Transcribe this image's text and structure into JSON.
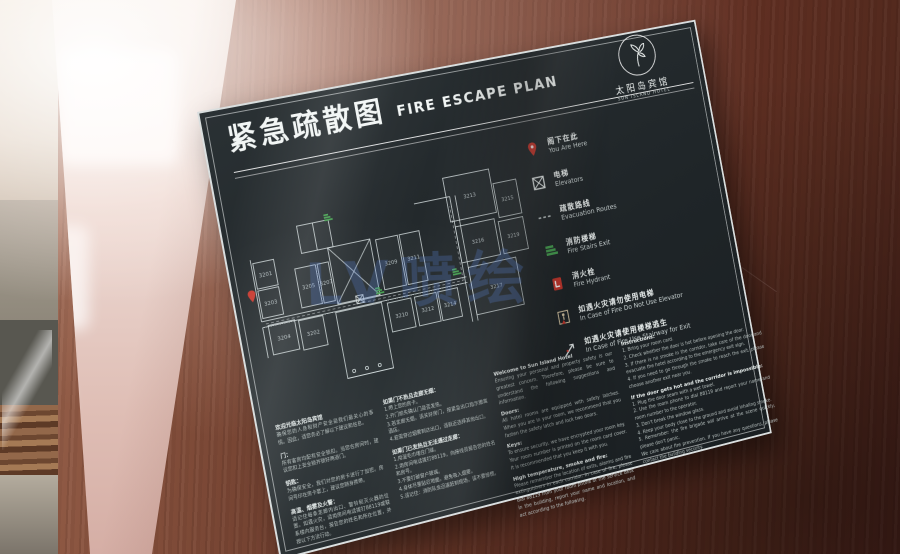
{
  "photo": {
    "watermark": "LV喷绘"
  },
  "sign": {
    "title_cn": "紧急疏散图",
    "title_en": "FIRE ESCAPE PLAN",
    "logo": {
      "name_cn": "太阳岛宾馆",
      "name_en": "SUN ISLAND HOTEL"
    },
    "colors": {
      "accent_red": "#c8372d",
      "stair_green": "#46a351",
      "wall_line": "#d8e1e2",
      "label": "#c6d0d2"
    },
    "legend": {
      "items": [
        {
          "icon": "you-are-here-pin",
          "cn": "阁下在此",
          "en": "You Are Here"
        },
        {
          "icon": "elevator",
          "cn": "电梯",
          "en": "Elevators"
        },
        {
          "icon": "evacuation-route",
          "cn": "疏散路线",
          "en": "Evacuation Routes"
        },
        {
          "icon": "fire-stairs",
          "cn": "消防楼梯",
          "en": "Fire Stairs Exit"
        },
        {
          "icon": "fire-hydrant",
          "cn": "消火栓",
          "en": "Fire Hydrant"
        },
        {
          "icon": "no-elevator",
          "cn": "如遇火灾请勿使用电梯",
          "en": "In Case of Fire Do Not Use Elevator"
        },
        {
          "icon": "stairway-exit",
          "cn": "如遇火灾请使用楼梯逃生",
          "en": "In Case of Fire Use Stairway for Exit"
        }
      ]
    },
    "plan": {
      "rooms": [
        {
          "n": "3201",
          "x": 20,
          "y": 82,
          "w": 22,
          "h": 26
        },
        {
          "n": "3203",
          "x": 20,
          "y": 110,
          "w": 22,
          "h": 28
        },
        {
          "n": "3205",
          "x": 62,
          "y": 96,
          "w": 22,
          "h": 40
        },
        {
          "n": "3207",
          "x": 86,
          "y": 96,
          "w": 12,
          "h": 40
        },
        {
          "n": "3209",
          "x": 152,
          "y": 84,
          "w": 24,
          "h": 52
        },
        {
          "n": "3211",
          "x": 178,
          "y": 84,
          "w": 22,
          "h": 52
        },
        {
          "n": "3213",
          "x": 236,
          "y": 36,
          "w": 52,
          "h": 46
        },
        {
          "n": "3215",
          "x": 290,
          "y": 52,
          "w": 26,
          "h": 36
        },
        {
          "n": "3216",
          "x": 240,
          "y": 88,
          "w": 44,
          "h": 38
        },
        {
          "n": "3219",
          "x": 288,
          "y": 92,
          "w": 28,
          "h": 34
        },
        {
          "n": "3217",
          "x": 246,
          "y": 132,
          "w": 54,
          "h": 50
        },
        {
          "n": "3210",
          "x": 152,
          "y": 150,
          "w": 26,
          "h": 30
        },
        {
          "n": "3212",
          "x": 182,
          "y": 150,
          "w": 24,
          "h": 30
        },
        {
          "n": "3214",
          "x": 208,
          "y": 150,
          "w": 22,
          "h": 30
        },
        {
          "n": "3202",
          "x": 56,
          "y": 148,
          "w": 26,
          "h": 30
        },
        {
          "n": "3204",
          "x": 24,
          "y": 146,
          "w": 28,
          "h": 30
        }
      ]
    },
    "columns": {
      "list": [
        {
          "id": "cn-info",
          "blocks": [
            {
              "h": "欢迎光临太阳岛宾馆",
              "p": "确保您的人身和财产安全是我们最关心的事情。因此，请您务必了解以下建议和信息。"
            },
            {
              "h": "门：",
              "p": "所有客房均配有安全锁扣。当您在房间时，建议您扣上安全锁并锁好两道门。"
            },
            {
              "h": "钥匙：",
              "p": "为确保安全，我们对您的房卡进行了加密。房间号印在房卡套上，建议您随身携带。"
            },
            {
              "h": "高温、烟雾及火警：",
              "p": "请记住每条走廊内出口、警铃和灭火器的位置。如遇火灾，请用房间电话拨打88119或联系楼内服务台，报告您的姓名和所在位置，并按以下方法行动。"
            }
          ]
        },
        {
          "id": "cn-instructions",
          "blocks": [
            {
              "h": "如果门不热且走廊无烟：",
              "p": "1.带上您的房卡。\n2.开门前先确认门是否发热。\n3.若走廊无烟，请关好房门，按紧急出口指示撤离酒店。\n4.若需穿过烟雾到达出口，请就近选择其他出口。"
            },
            {
              "h": "如果门已发热且无法通过走廊：",
              "p": "1.用湿毛巾堵住门缝。\n2.用房间电话拨打88119，向接线员报告您的姓名和房号。\n3.不要打破窗户玻璃。\n4.身体尽量贴近地面，避免吸入烟雾。\n5.请记住：消防队会迅速赶到现场，请不要惊慌。"
            }
          ]
        },
        {
          "id": "en-info",
          "blocks": [
            {
              "h": "Welcome to Sun Island Hotel",
              "p": "Ensuring your personal and property safety is our greatest concern. Therefore, please be sure to understand the following suggestions and information."
            },
            {
              "h": "Doors:",
              "p": "All hotel rooms are equipped with safety latches. When you are in your room, we recommend that you fasten the safety latch and lock two doors."
            },
            {
              "h": "Keys:",
              "p": "To ensure security, we have encrypted your room key. Your room number is printed on the room card cover. It is recommended that you keep it with you."
            },
            {
              "h": "High temperature, smoke and fire:",
              "p": "Please remember the location of exits, alarms and fire extinguishers in each corridor. In case of fire, please dial 88119 from your room phone or the service desk in the building, report your name and location, and act according to the following."
            }
          ]
        },
        {
          "id": "en-instructions",
          "blocks": [
            {
              "h": "Instructions:",
              "p": "1. Bring your room card.\n2. Check whether the door is hot before opening the door.\n3. If there is no smoke in the corridor, take care of the door and evacuate the hotel according to the emergency exit sign.\n4. If you need to go through the smoke to reach the exit, please choose another exit near you."
            },
            {
              "h": "If the door gets hot and the corridor is impossible:",
              "p": "1. Plug the door seam with a wet towel.\n2. Use the room phone to dial 88119 and report your name and room number to the operator.\n3. Don't break the window glass.\n4. Keep your body close to the ground and avoid inhaling smoke.\n5. Remember: the fire brigade will arrive at the scene quickly, please don't panic."
            },
            {
              "h": "",
              "p": "We care about fire prevention. If you have any questions, please contact the building security."
            }
          ]
        }
      ]
    }
  }
}
